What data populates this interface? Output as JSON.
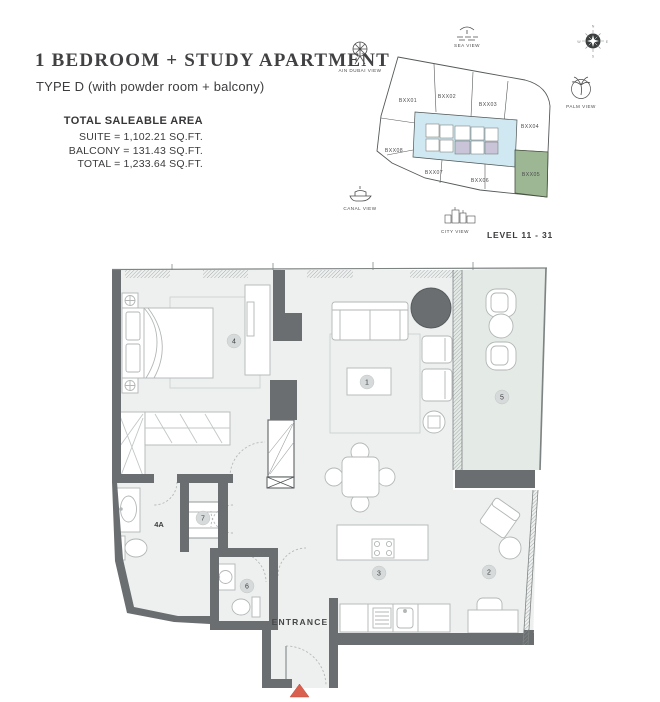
{
  "header": {
    "title": "1 BEDROOM + STUDY APARTMENT",
    "subtitle": "TYPE D (with powder room + balcony)",
    "area_heading": "TOTAL SALEABLE AREA",
    "area_lines": [
      "SUITE = 1,102.21 SQ.FT.",
      "BALCONY = 131.43 SQ.FT.",
      "TOTAL = 1,233.64 SQ.FT."
    ]
  },
  "keyplan": {
    "views": {
      "ain_dubai": "AIN DUBAI VIEW",
      "sea": "SEA VIEW",
      "palm": "PALM VIEW",
      "canal": "CANAL VIEW",
      "city": "CITY VIEW"
    },
    "compass": {
      "n": "N",
      "e": "E",
      "s": "S",
      "w": "W"
    },
    "units": [
      "BXX01",
      "BXX02",
      "BXX03",
      "BXX04",
      "BXX05",
      "BXX06",
      "BXX07",
      "BXX08"
    ],
    "highlighted_unit": "BXX05",
    "level": "LEVEL 11 - 31"
  },
  "floorplan": {
    "entrance": "ENTRANCE",
    "room_labels": {
      "living": "1",
      "study": "2",
      "kitchen": "3",
      "bedroom": "4",
      "bathroom": "4A",
      "balcony": "5",
      "powder": "6",
      "closet": "7"
    }
  },
  "colors": {
    "highlight_green": "#9db694",
    "core_blue": "#cfe8f1",
    "cell_purple": "#cac4d8",
    "wall_gray": "#6a6e70",
    "balcony_floor": "#e4eae5",
    "floor": "#edf0ef",
    "entrance_marker": "#d9604f"
  }
}
